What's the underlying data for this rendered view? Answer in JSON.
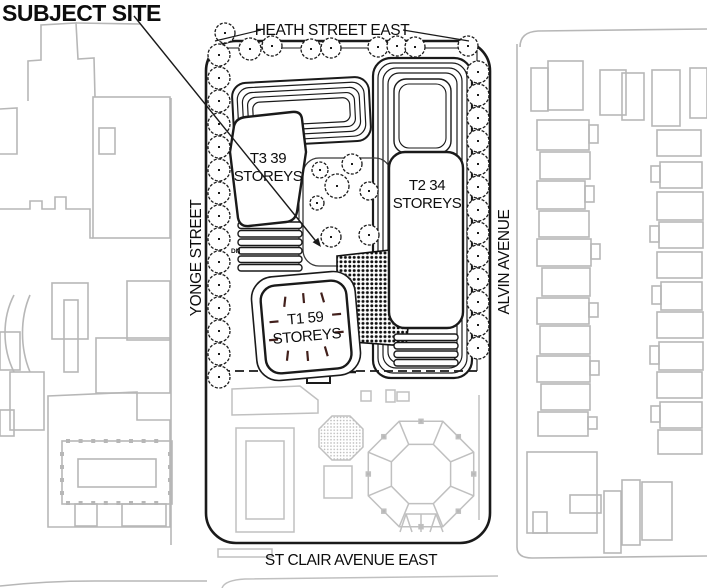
{
  "title": "SUBJECT SITE",
  "streets": {
    "north": "HEATH STREET EAST",
    "south": "ST CLAIR AVENUE EAST",
    "west": "YONGE STREET",
    "east": "ALVIN AVENUE"
  },
  "towers": {
    "t1": {
      "line1": "T1 59",
      "line2": "STOREYS"
    },
    "t2": {
      "line1": "T2 34",
      "line2": "STOREYS"
    },
    "t3": {
      "line1": "T3 39",
      "line2": "STOREYS"
    }
  },
  "annotations": {
    "down": "DN"
  },
  "colors": {
    "line": "#1a1a1a",
    "context": "#b7b7b7",
    "text": "#0d0d0d",
    "dash": "#42201c",
    "background": "#ffffff"
  }
}
